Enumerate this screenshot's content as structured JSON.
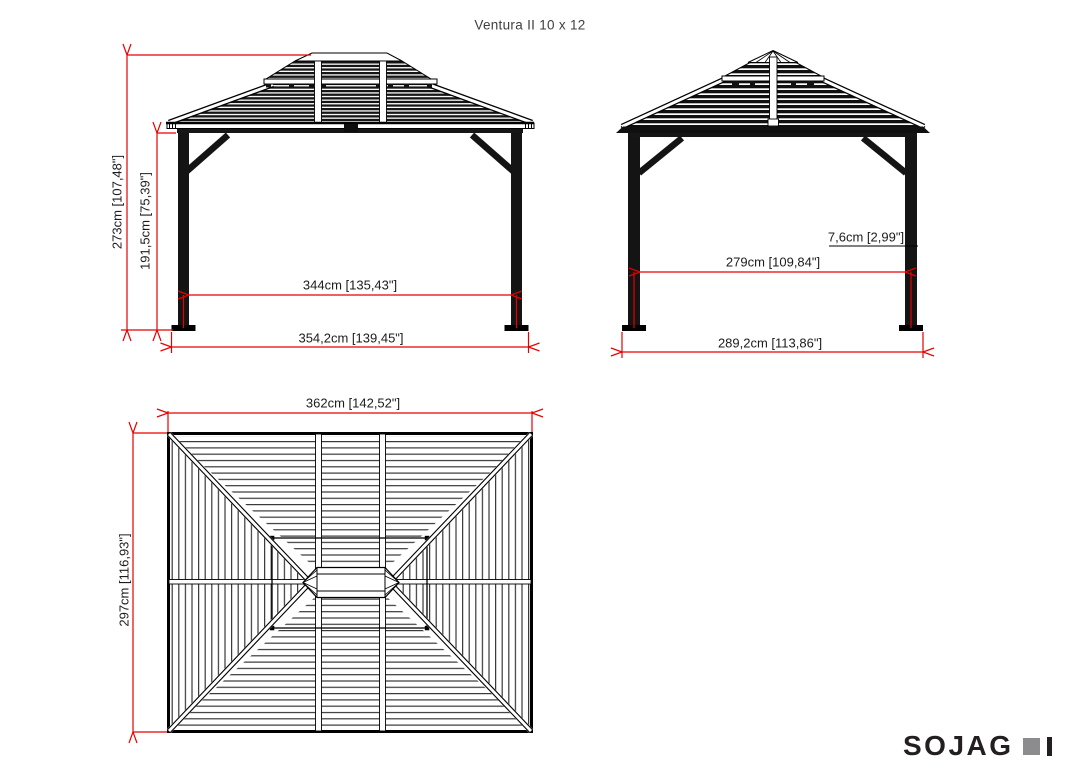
{
  "title": "Ventura II 10 x 12",
  "views": {
    "front": {
      "dims": {
        "overall_height": "273cm [107,48\"]",
        "post_height": "191,5cm [75,39\"]",
        "inner_width": "344cm [135,43\"]",
        "outer_width": "354,2cm [139,45\"]"
      }
    },
    "side": {
      "dims": {
        "post_width": "7,6cm [2,99\"]",
        "inner_depth": "279cm [109,84\"]",
        "outer_depth": "289,2cm [113,86\"]"
      }
    },
    "top": {
      "dims": {
        "roof_width": "362cm [142,52\"]",
        "roof_depth": "297cm [116,93\"]"
      }
    }
  },
  "logo": {
    "brand": "SOJAG",
    "marks": [
      "gray-square",
      "dark-bar"
    ]
  },
  "colors": {
    "dim-red": "#e60000",
    "text-dark": "#1c1c1c",
    "title-gray": "#3f3f3f",
    "logo-dark": "#231f20",
    "logo-gray": "#8c8c8e"
  }
}
